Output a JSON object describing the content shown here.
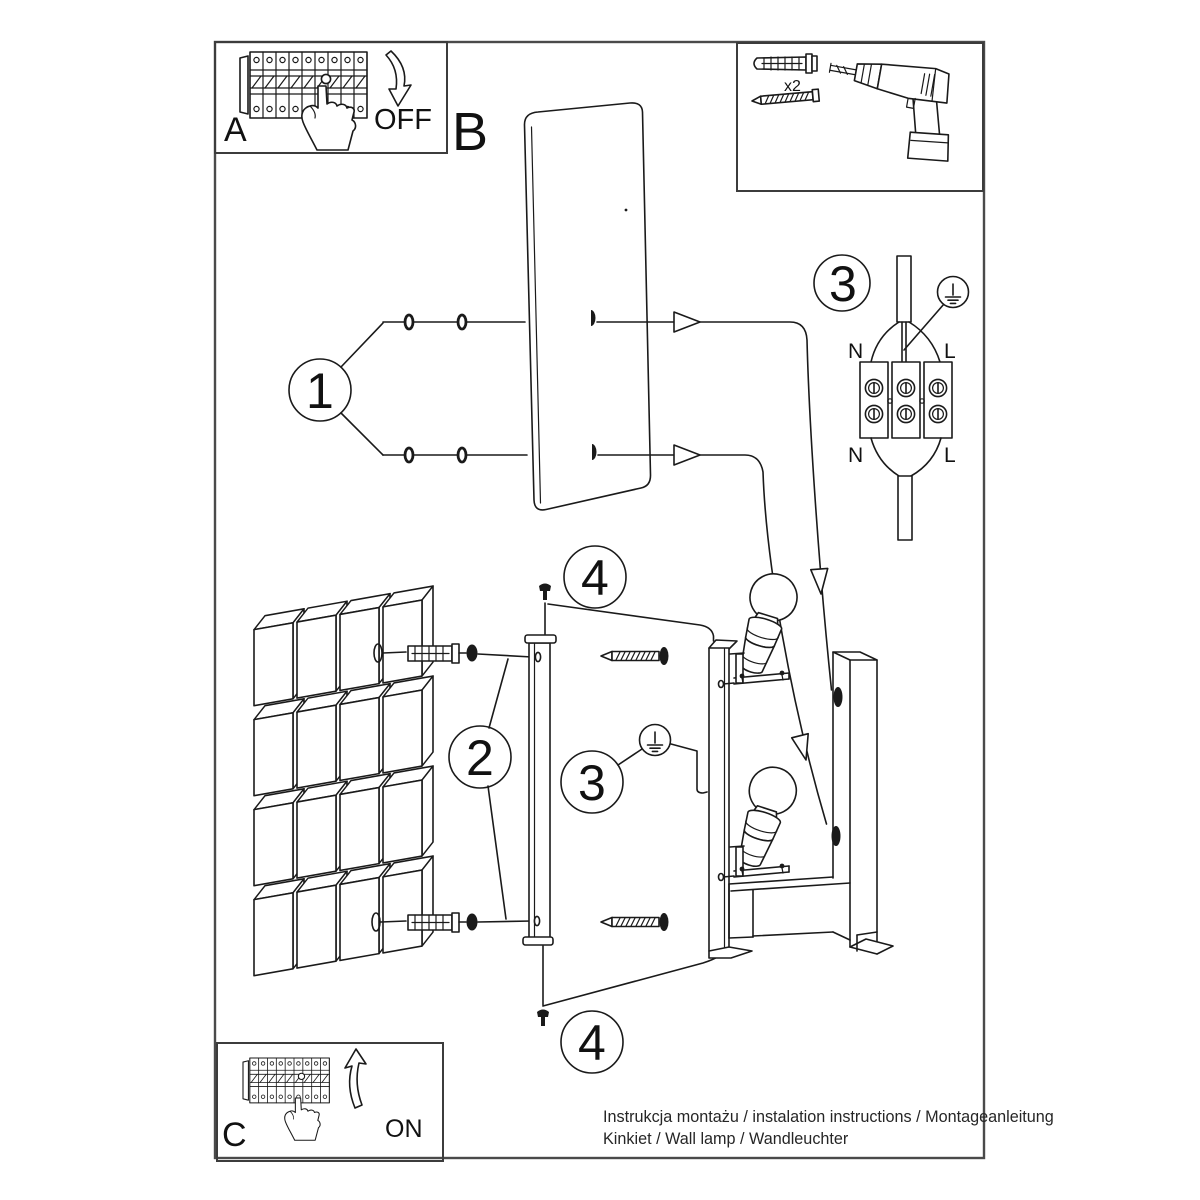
{
  "colors": {
    "line": "#1a1a1a",
    "frame": "#4a4a4a",
    "background": "#ffffff"
  },
  "boxes": {
    "power_off": {
      "letter": "A",
      "label": "OFF"
    },
    "power_on": {
      "letter": "C",
      "label": "ON"
    },
    "tools": {
      "dowel_qty": "x2"
    }
  },
  "cover": {
    "letter": "B"
  },
  "callouts": {
    "one": "1",
    "two": "2",
    "three": "3",
    "four": "4"
  },
  "wiring": {
    "top_left": "N",
    "top_right": "L",
    "bottom_left": "N",
    "bottom_right": "L"
  },
  "footer": {
    "line1": "Instrukcja montażu / instalation instructions / Montageanleitung",
    "line2": "Kinkiet / Wall lamp / Wandleuchter"
  }
}
